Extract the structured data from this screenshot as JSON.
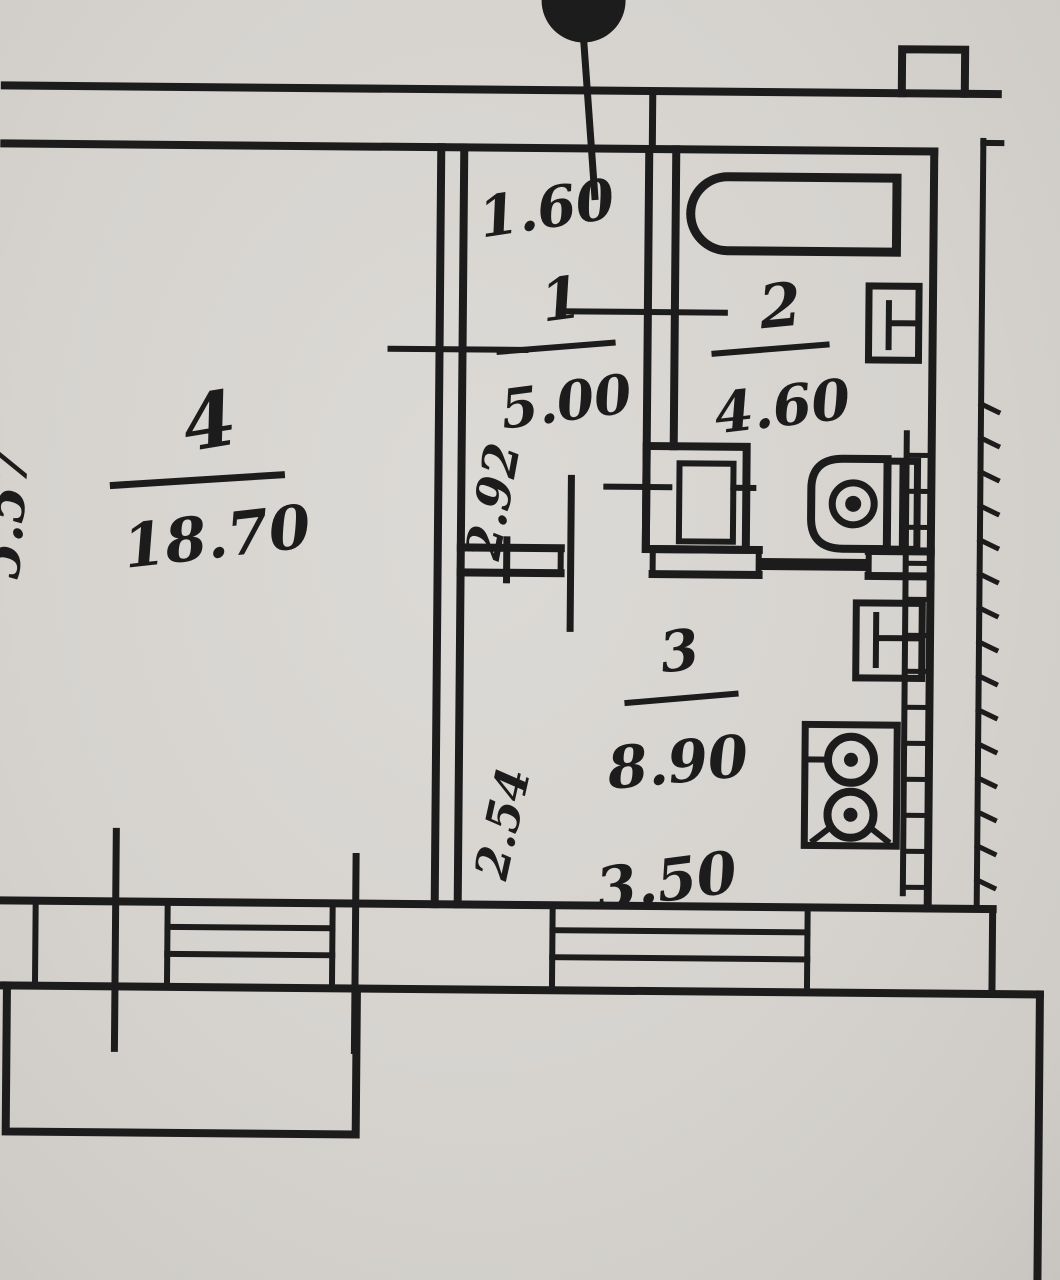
{
  "document": {
    "kind": "hand-drawn apartment floor plan (scanned photo)",
    "paper_color": "#d6d3cf",
    "ink_color": "#1c1c1c"
  },
  "rooms": {
    "r1": {
      "number": "1",
      "area": "5.00"
    },
    "r2": {
      "number": "2",
      "area": "4.60"
    },
    "r3": {
      "number": "3",
      "area": "8.90"
    },
    "r4": {
      "number": "4",
      "area": "18.70"
    }
  },
  "dimensions": {
    "top_width": "1.60",
    "left_height": "5.57",
    "hall_depth": "2.92",
    "kitchen_depth": "2.54",
    "kitchen_width": "3.50"
  },
  "fixtures": [
    "bathtub",
    "wash-basin-bathroom",
    "toilet",
    "vent-duct",
    "kitchen-sink",
    "stove-two-burner",
    "window-living-room",
    "window-kitchen",
    "balcony",
    "door-axis-marker",
    "leader-dot"
  ]
}
